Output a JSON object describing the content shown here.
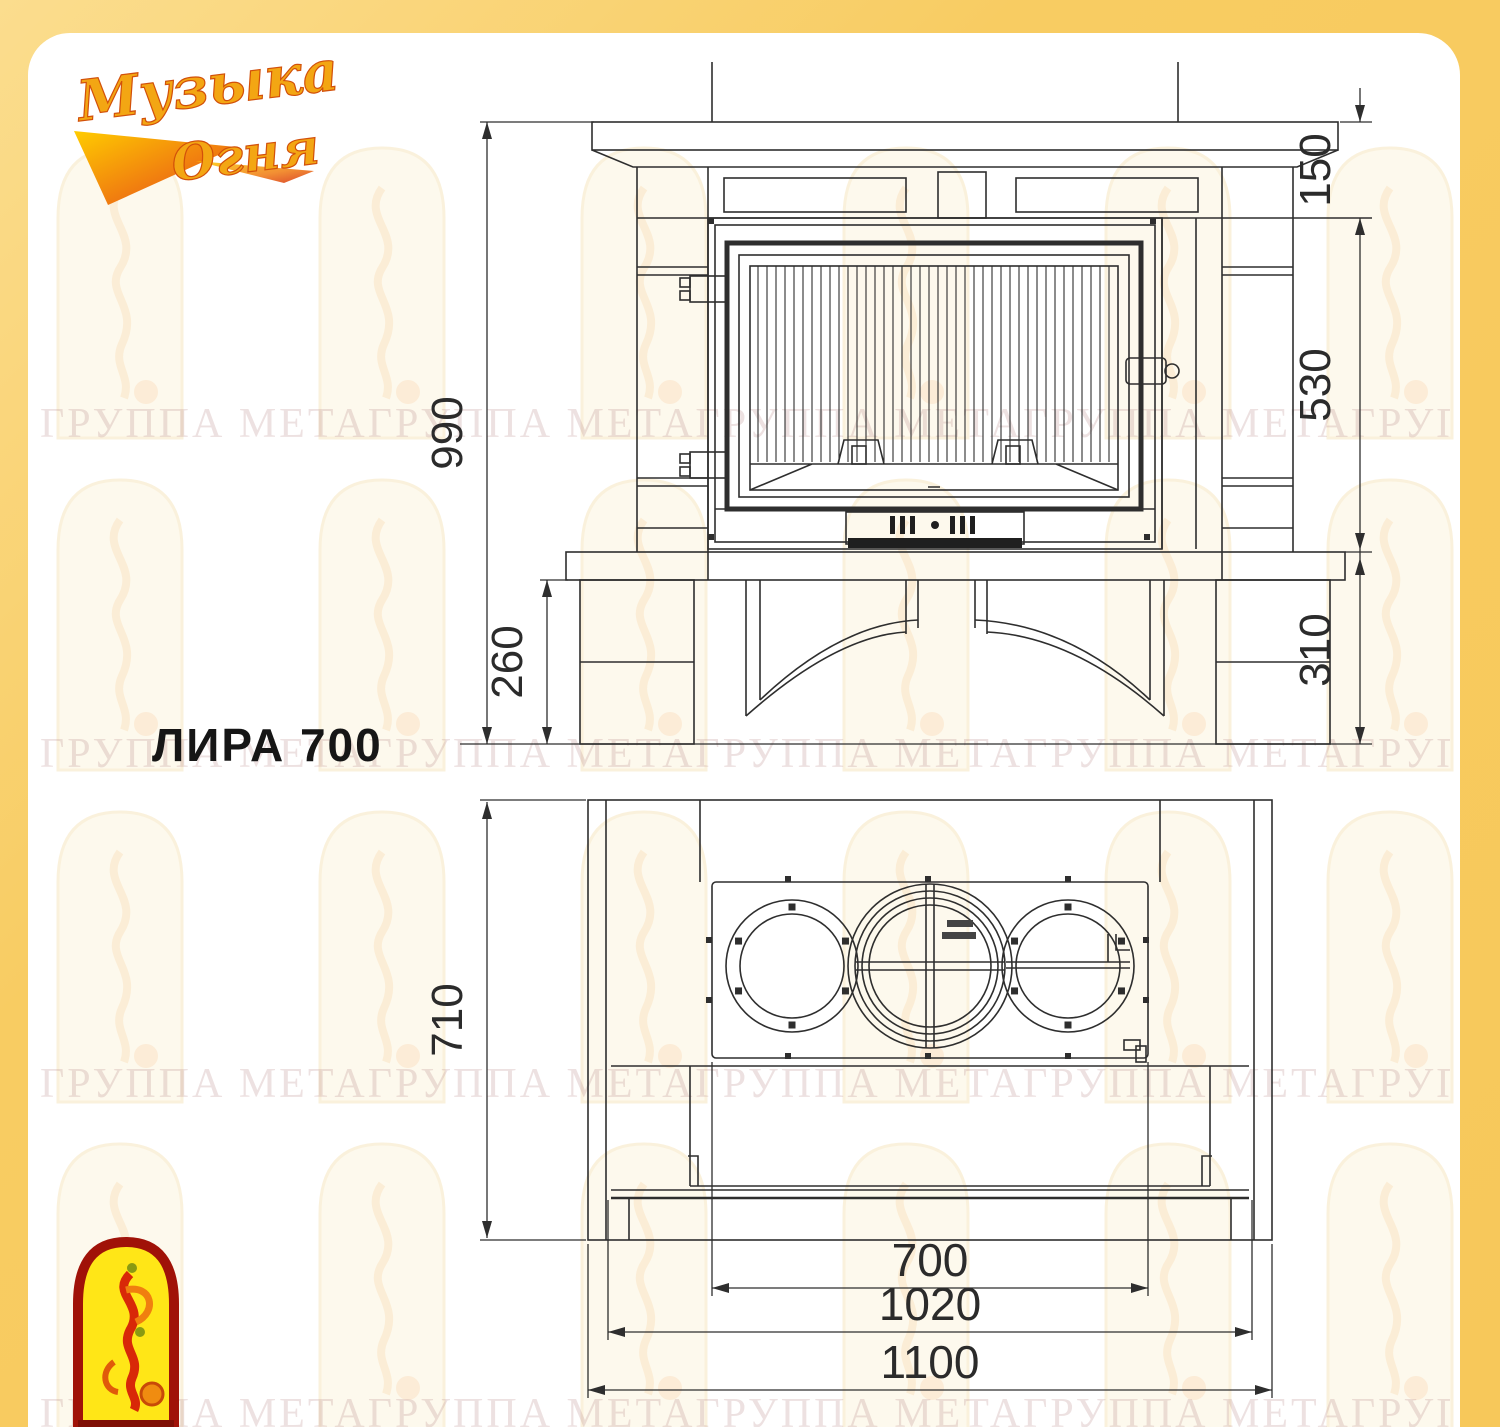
{
  "brand_logo": {
    "line1": "Музыка",
    "line2": "Огня"
  },
  "model_label": "ЛИРА 700",
  "watermark_text": "ГРУППА МЕТАГРУППА МЕТАГРУППА МЕТАГРУППА МЕТАГРУППА МЕТАГРУППА МЕТА",
  "front_view": {
    "dims": {
      "total_height": "990",
      "base_height": "260",
      "mantel_zone_height": "150",
      "firebox_zone_height": "530",
      "hearth_zone_height": "310"
    }
  },
  "plan_view": {
    "dims": {
      "depth": "710",
      "firebox_width": "700",
      "inner_width": "1020",
      "overall_width": "1100"
    }
  },
  "colors": {
    "page_bg": "#F8CC62",
    "panel_bg": "#FFFFFF",
    "line": "#2E2E2E",
    "watermark": "#BA8C8C",
    "brand_gold": "#F3A613",
    "brand_red": "#E83808",
    "bird_yellow": "#FFE617",
    "bird_red": "#A01208"
  }
}
